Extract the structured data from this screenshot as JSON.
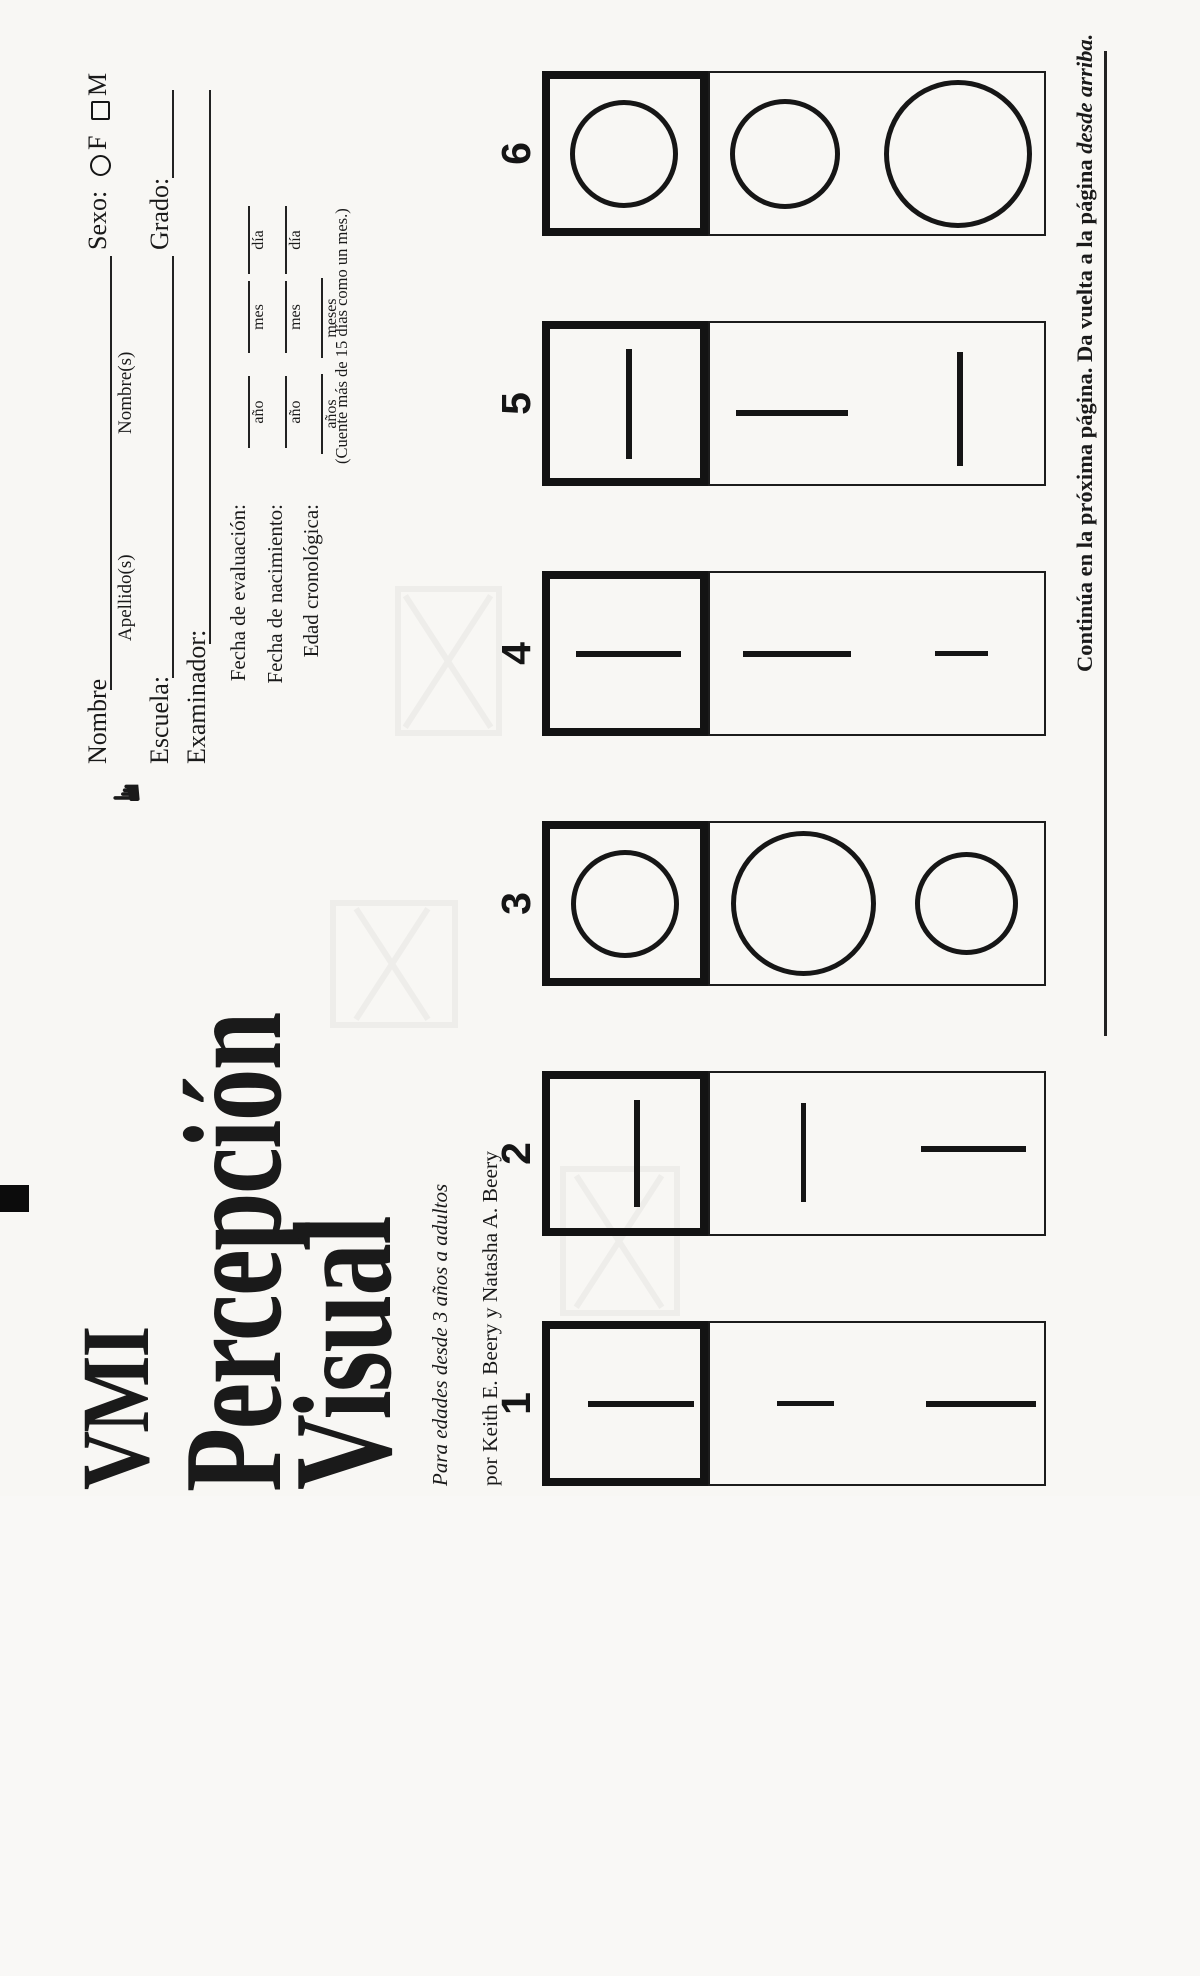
{
  "form": {
    "hand_icon": "manicule",
    "nombre_label": "Nombre",
    "apellido_sublabel": "Apellido(s)",
    "nombres_sublabel": "Nombre(s)",
    "sexo_label": "Sexo:",
    "sexo_f": "F",
    "sexo_m": "M",
    "escuela_label": "Escuela:",
    "grado_label": "Grado:",
    "examinador_label": "Examinador:",
    "date_rows": [
      {
        "label": "Fecha de evaluación:",
        "cols": [
          "año",
          "mes",
          "día"
        ]
      },
      {
        "label": "Fecha de nacimiento:",
        "cols": [
          "año",
          "mes",
          "día"
        ]
      },
      {
        "label": "Edad cronológica:",
        "cols": [
          "años",
          "meses"
        ]
      }
    ],
    "count_note": "(Cuente más de 15 días como un mes.)"
  },
  "title": {
    "vmi": "VMI",
    "line1": "Percepción",
    "line2": "Visual",
    "subtitle": "Para edades desde 3 años a adultos",
    "authors": "por Keith E. Beery y Natasha A. Beery"
  },
  "items": [
    {
      "number": "1",
      "x": 10,
      "stimulus": {
        "shape": "vline",
        "cx": 82,
        "top": 588,
        "len": 106,
        "w": 6
      },
      "choices": [
        {
          "shape": "vline",
          "cx": 82,
          "top": 777,
          "len": 57,
          "w": 5
        },
        {
          "shape": "vline",
          "cx": 82,
          "top": 926,
          "len": 110,
          "w": 6
        }
      ]
    },
    {
      "number": "2",
      "x": 260,
      "stimulus": {
        "shape": "hline",
        "left": 29,
        "cy": 637,
        "len": 107,
        "w": 6
      },
      "choices": [
        {
          "shape": "hline",
          "left": 34,
          "cy": 803,
          "len": 99,
          "w": 5
        },
        {
          "shape": "vline",
          "cx": 87,
          "top": 921,
          "len": 105,
          "w": 6
        }
      ]
    },
    {
      "number": "3",
      "x": 510,
      "stimulus": {
        "shape": "circle",
        "cx": 82,
        "cy": 625,
        "d": 108
      },
      "choices": [
        {
          "shape": "circle",
          "cx": 82,
          "cy": 803,
          "d": 145
        },
        {
          "shape": "circle",
          "cx": 82,
          "cy": 966,
          "d": 103
        }
      ]
    },
    {
      "number": "4",
      "x": 760,
      "stimulus": {
        "shape": "vline",
        "cx": 82,
        "top": 576,
        "len": 105,
        "w": 6
      },
      "choices": [
        {
          "shape": "vline",
          "cx": 82,
          "top": 743,
          "len": 108,
          "w": 6
        },
        {
          "shape": "vline",
          "cx": 82,
          "top": 935,
          "len": 53,
          "w": 5
        }
      ]
    },
    {
      "number": "5",
      "x": 1010,
      "stimulus": {
        "shape": "hline",
        "left": 27,
        "cy": 629,
        "len": 110,
        "w": 6
      },
      "choices": [
        {
          "shape": "vline",
          "cx": 73,
          "top": 736,
          "len": 112,
          "w": 6
        },
        {
          "shape": "hline",
          "left": 20,
          "cy": 960,
          "len": 114,
          "w": 6
        }
      ]
    },
    {
      "number": "6",
      "x": 1260,
      "stimulus": {
        "shape": "circle",
        "cx": 82,
        "cy": 624,
        "d": 108
      },
      "choices": [
        {
          "shape": "circle",
          "cx": 82,
          "cy": 785,
          "d": 110
        },
        {
          "shape": "circle",
          "cx": 82,
          "cy": 958,
          "d": 148
        }
      ]
    }
  ],
  "footer": {
    "note_main": "Continúa en la próxima página. Da vuelta a la página ",
    "note_italic": "desde arriba."
  },
  "colors": {
    "ink": "#151515",
    "paper": "#f8f7f4"
  }
}
